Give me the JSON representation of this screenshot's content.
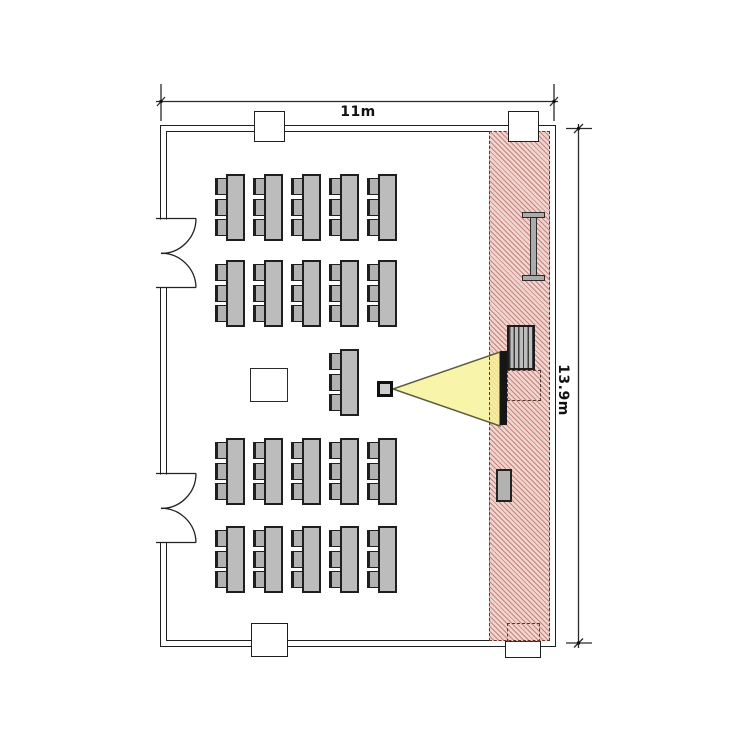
{
  "diagram": {
    "type": "floor-plan",
    "room": "classroom-with-projector",
    "dimension_labels": {
      "width": "11m",
      "height": "13.9m"
    }
  },
  "colors": {
    "wall_line": "#1f1f1f",
    "furniture_fill": "#bcbcbc",
    "furniture_line": "#1f1f1f",
    "hatch_base": "#f0d4cf",
    "hatch_line": "#c5847c",
    "hatch_border": "#6e2f28",
    "cone_fill": "rgba(247,242,150,0.82)",
    "cone_line": "#5c5c3d",
    "screen_fill": "#161616",
    "dimension_line": "#2a2a2a"
  },
  "furniture": {
    "student_tables": {
      "columns_x": [
        226,
        264,
        302,
        340,
        378
      ],
      "rows_y": [
        174,
        260,
        438,
        526
      ],
      "extra_tables": [
        {
          "x": 340,
          "y": 349
        }
      ],
      "table_size": {
        "w": 19,
        "h": 67
      },
      "chairs_per_table": 3,
      "chair_offsets_y": [
        4,
        25,
        45
      ],
      "chair_size": {
        "w": 12,
        "h": 17
      }
    },
    "table_count_total": 21,
    "doors": 2,
    "front_zone_items": [
      "wall-rail",
      "teacher-desk",
      "projection-screen",
      "cabinet"
    ]
  }
}
